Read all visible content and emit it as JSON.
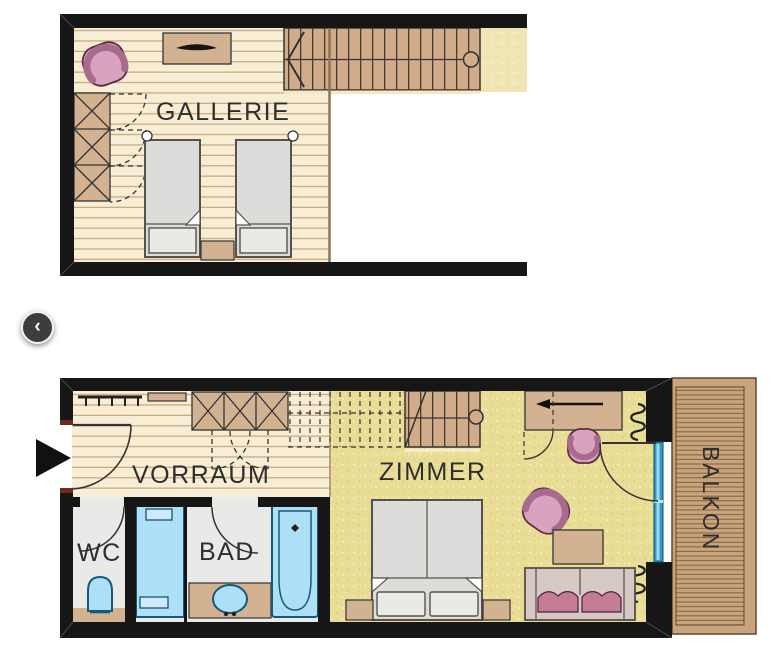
{
  "page": {
    "background": "#ffffff"
  },
  "labels": {
    "gallerie": "GALLERIE",
    "vorraum": "VORRAUM",
    "zimmer": "ZIMMER",
    "wc": "WC",
    "bad": "BAD",
    "balkon": "BALKON"
  },
  "carousel": {
    "prev_icon": "chevron-left-icon",
    "prev_glyph": "‹"
  },
  "markers": {
    "entrance_icon": "entrance-arrow-icon",
    "entrance_glyph": "▶"
  },
  "colors": {
    "wall": "#161616",
    "wood_floor": "#f8eed6",
    "wood_floor_line": "#c9ab7e",
    "furniture_tan": "#d3b291",
    "stair_tan": "#d0ac8b",
    "carpet_yellow": "#e9dc95",
    "open_area_sand": "#f1e5b3",
    "fixture_blue": "#ade0f7",
    "fixture_blue_border": "#135a78",
    "glass_blue": "#2e9cc4",
    "tile_gray": "#e9e9e7",
    "bed_gray": "#dcdcda",
    "sofa_gray": "#d6c9c5",
    "accent_pink_light": "#d9a3c0",
    "accent_pink_dark": "#a96a8f",
    "cushion_pink": "#c57d97",
    "balcony_wood": "#c9a37b",
    "label_text": "#2e2e2e"
  }
}
